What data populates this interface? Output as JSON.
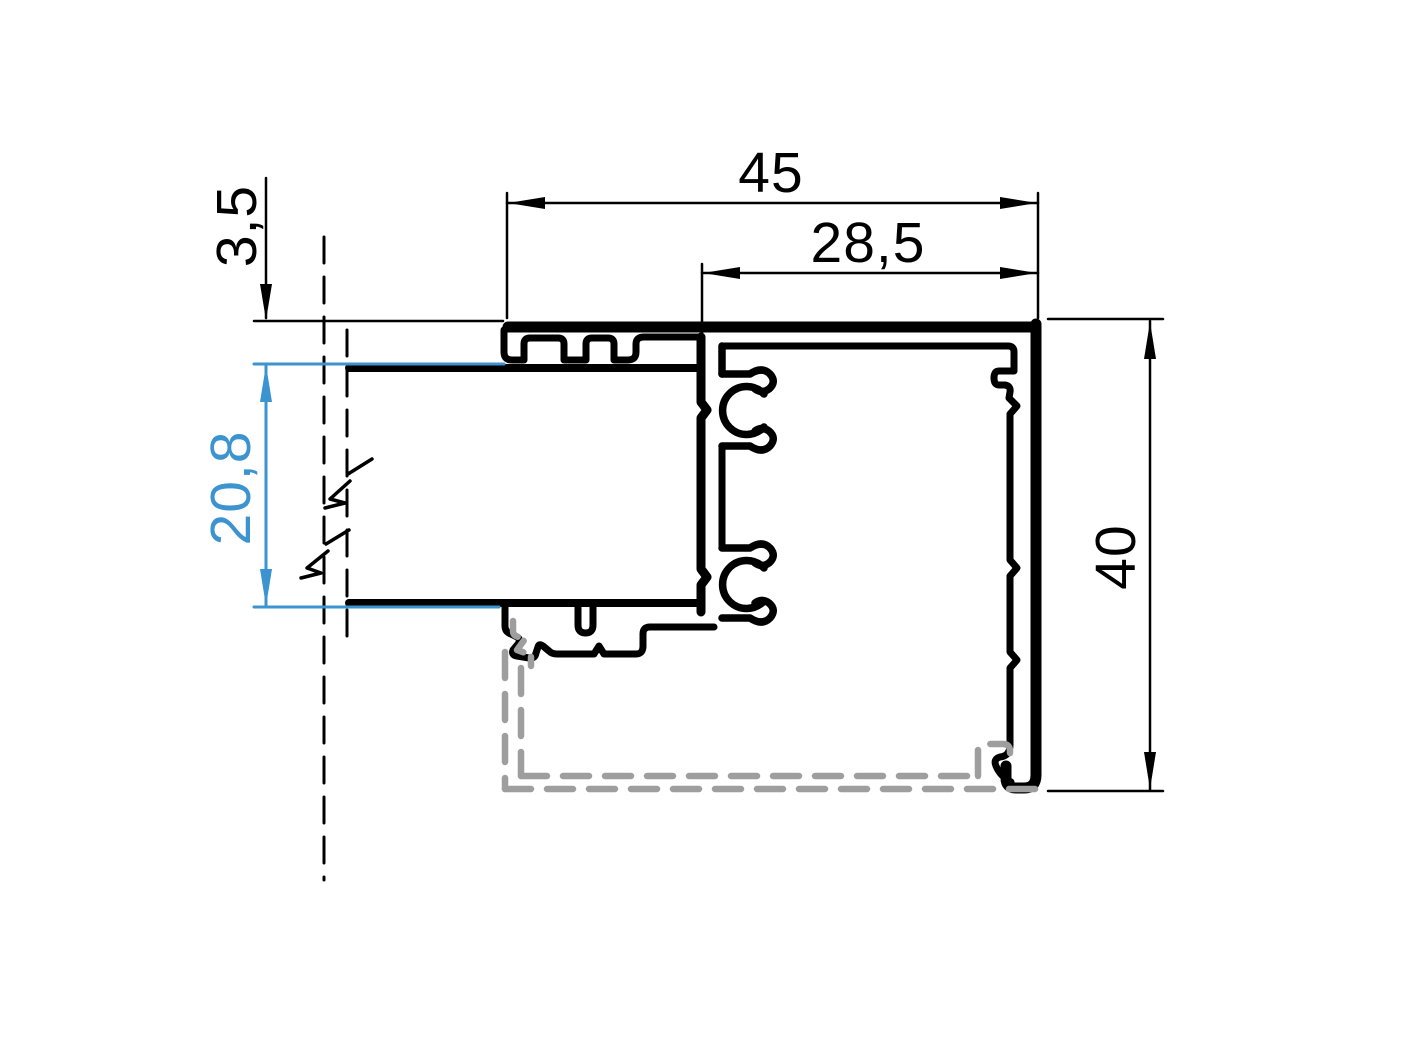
{
  "colors": {
    "ink": "#000000",
    "accent_blue": "#3b93d0",
    "phantom_gray": "#9e9e9e",
    "background": "#ffffff"
  },
  "dimensions": {
    "total_width": {
      "label": "45"
    },
    "inner_width": {
      "label": "28,5"
    },
    "bead_offset": {
      "label": "3,5"
    },
    "glass_thickness": {
      "label": "20,8"
    },
    "total_height": {
      "label": "40"
    }
  }
}
